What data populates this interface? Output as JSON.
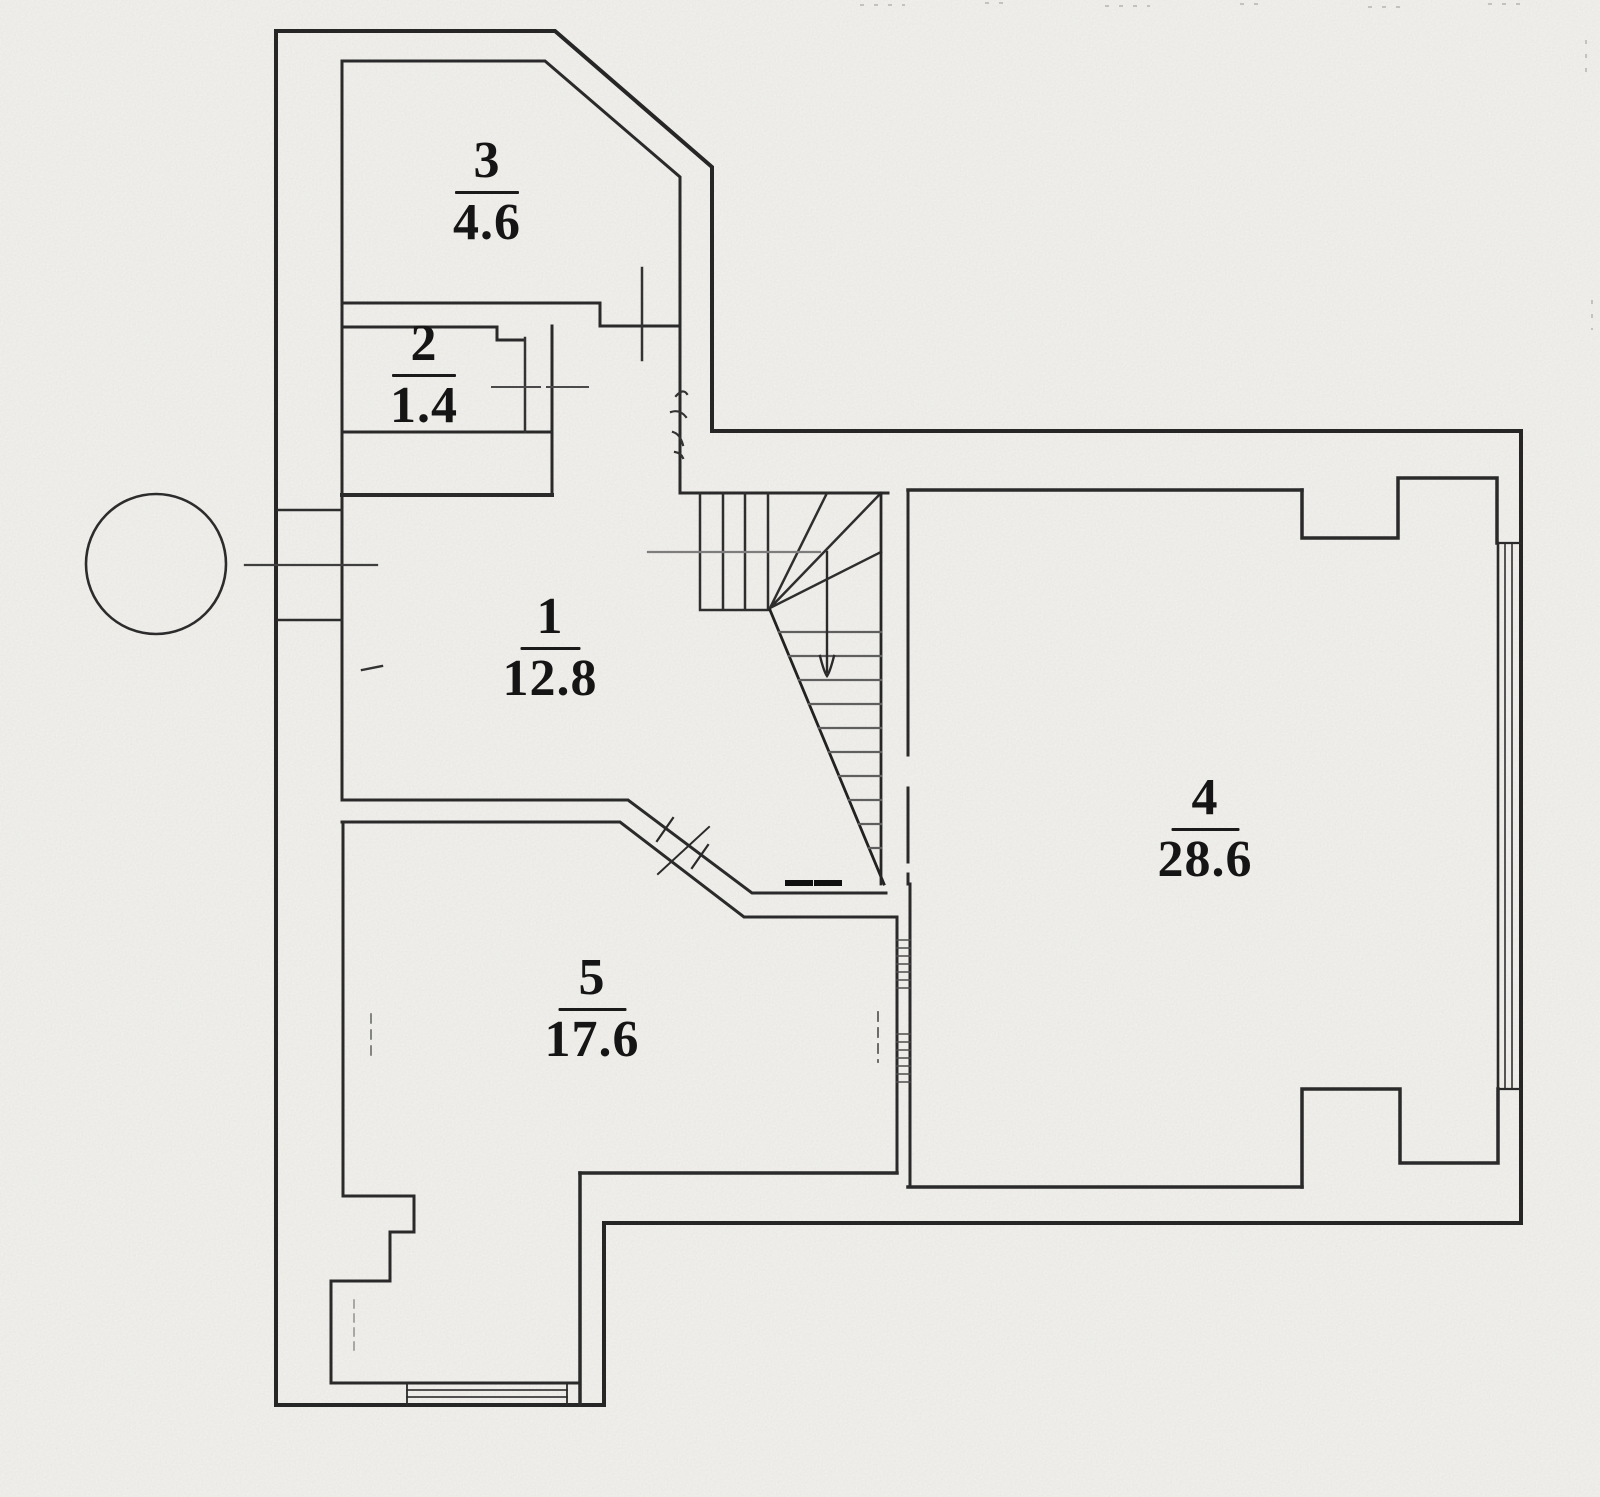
{
  "document": {
    "type": "scanned-floor-plan",
    "colors": {
      "paper": "#f7f6f2",
      "ink": "#262626",
      "faint_ink": "#7d7d7d"
    }
  },
  "rooms": [
    {
      "number": "3",
      "area": "4.6"
    },
    {
      "number": "2",
      "area": "1.4"
    },
    {
      "number": "1",
      "area": "12.8"
    },
    {
      "number": "4",
      "area": "28.6"
    },
    {
      "number": "5",
      "area": "17.6"
    }
  ],
  "annotations": {
    "stair_direction": "down"
  }
}
